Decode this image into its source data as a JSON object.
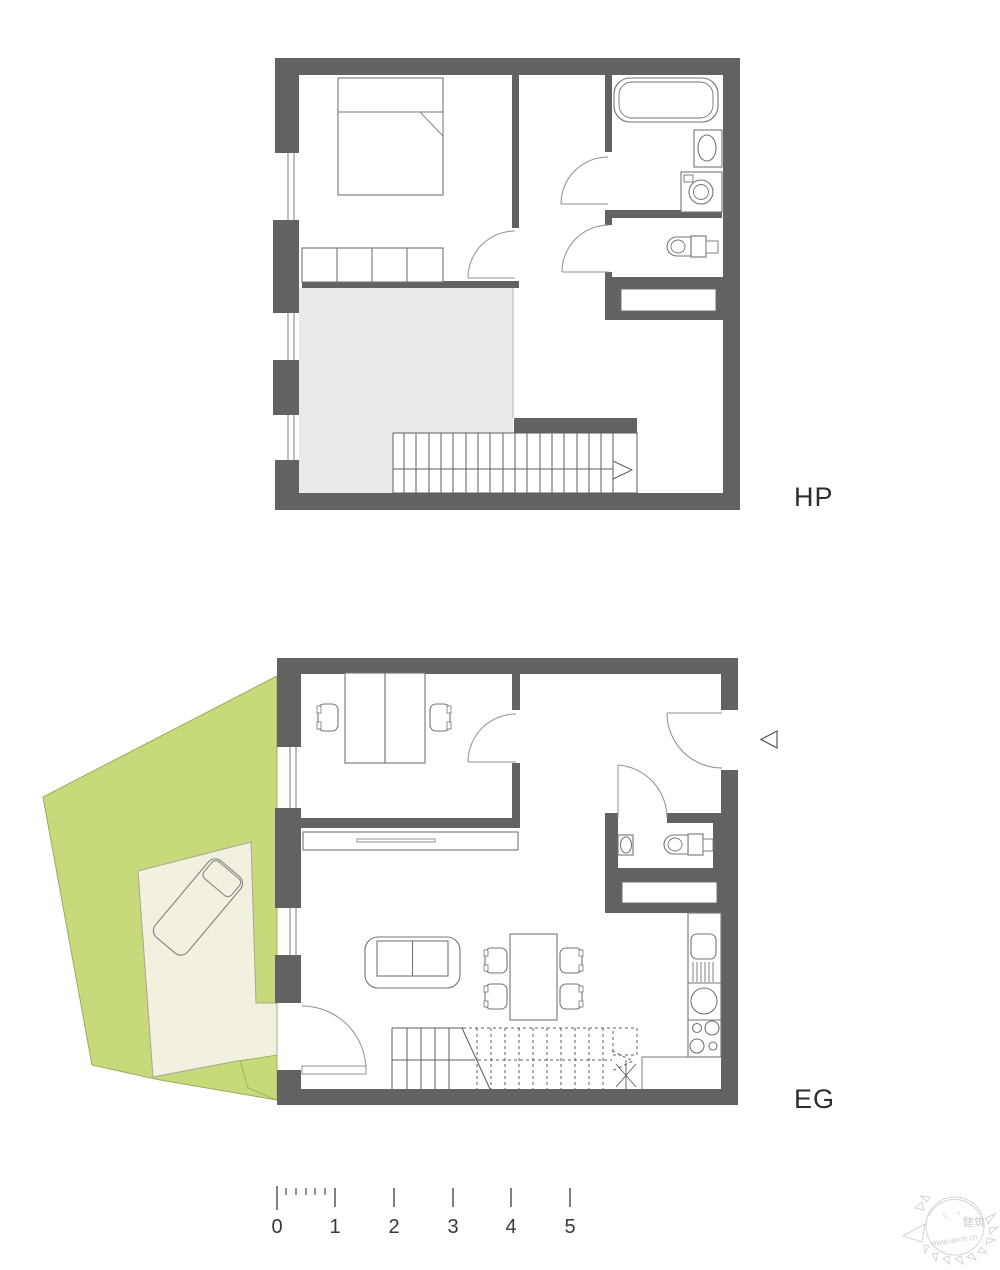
{
  "page": {
    "width": 1000,
    "height": 1265,
    "background": "#ffffff"
  },
  "colors": {
    "wall": "#616261",
    "furniture_line": "#757575",
    "door_line": "#8f8f8f",
    "void_gray": "#eaeaea",
    "garden_green": "#c7da7b",
    "terrace_cream": "#f2f0de",
    "label_text": "#2e2e2e"
  },
  "plans": {
    "hp": {
      "label": "HP"
    },
    "eg": {
      "label": "EG"
    }
  },
  "scale_bar": {
    "ticks": [
      "0",
      "1",
      "2",
      "3",
      "4",
      "5"
    ]
  },
  "watermark": {
    "caption": "建筑",
    "url": "www.iarch.cn"
  }
}
